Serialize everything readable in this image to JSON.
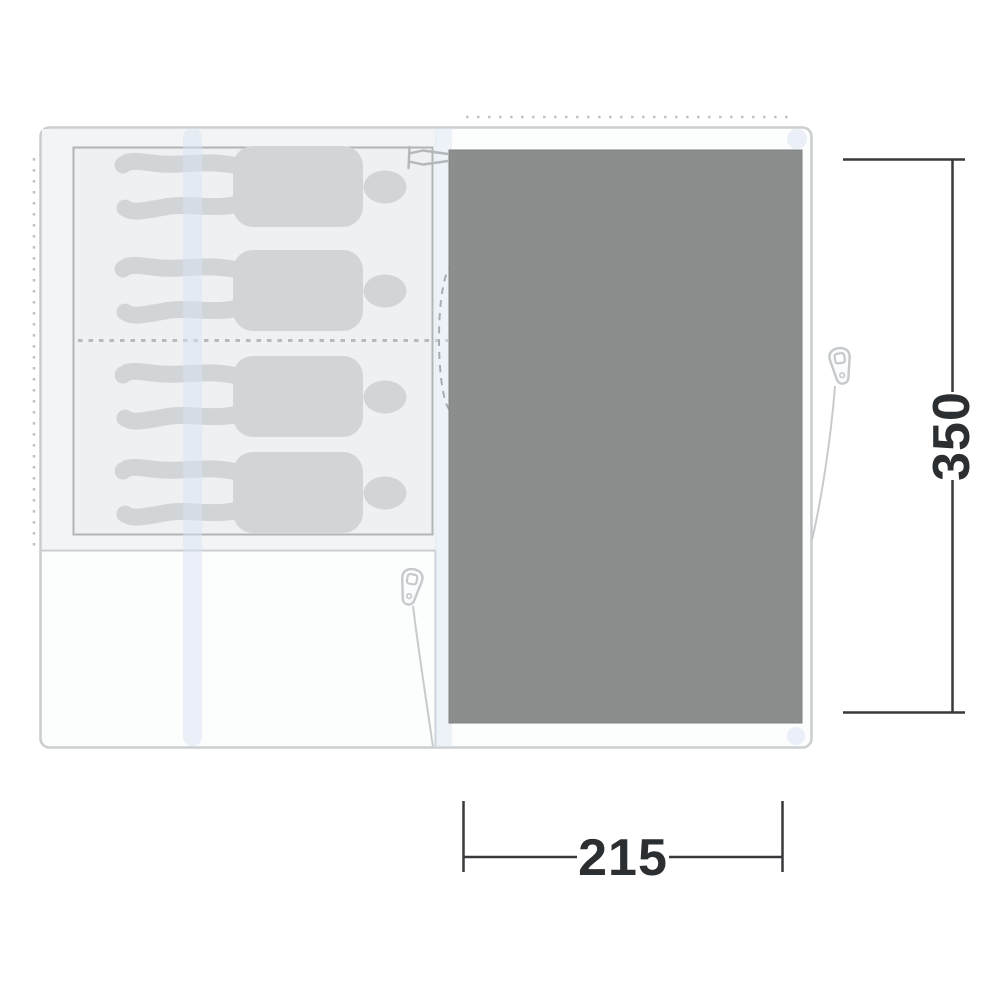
{
  "diagram": {
    "type": "tent-floorplan-top-view",
    "dimension_labels": {
      "depth": "350",
      "width": "215"
    },
    "sleeping_capacity": 4,
    "icons": [
      "person-silhouette",
      "zipper-pull-icon",
      "toggle-clip-icon",
      "guyline",
      "door-swing-arc"
    ],
    "colors": {
      "living_groundsheet": "#8b8e8d",
      "outline_border": "#cbced0",
      "bedroom_fill": "#f3f4f5",
      "cabin_fill": "#eff0f2",
      "cabin_border": "#b2b5b8",
      "silhouette": "#d2d5d7",
      "pole_stripe": "#d9e3f3",
      "dimension_line": "#37393c",
      "dimension_text": "#2c2f31"
    }
  }
}
